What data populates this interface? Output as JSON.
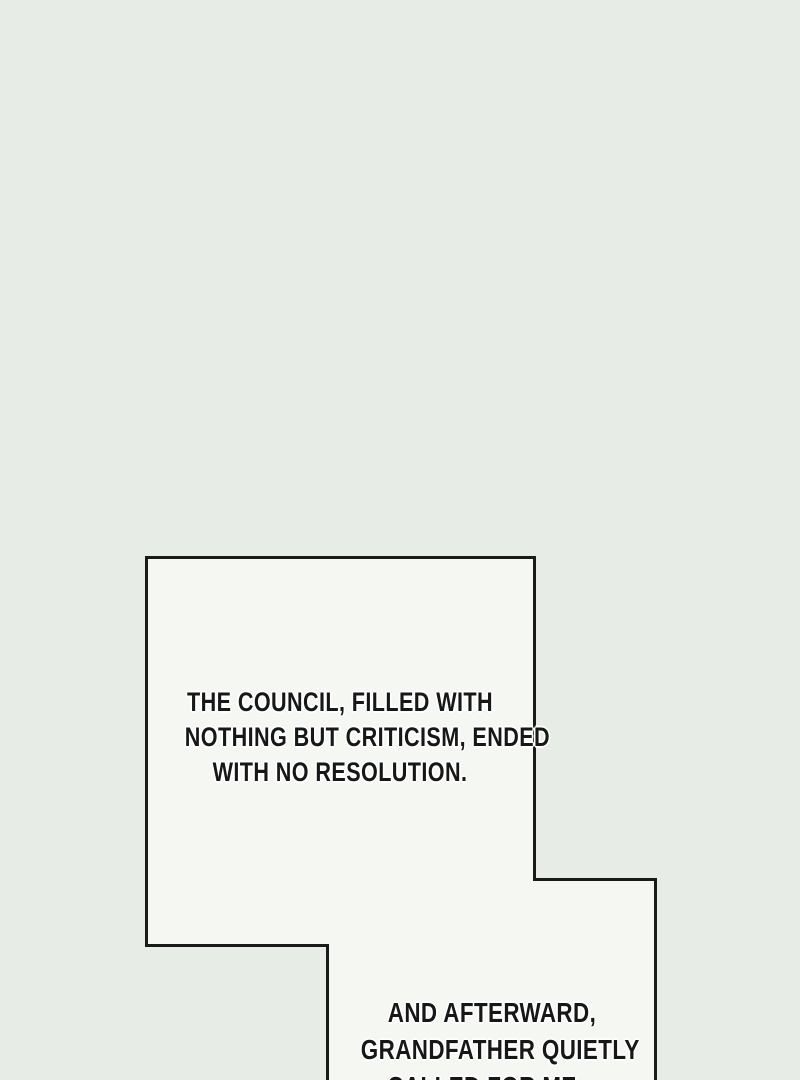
{
  "colors": {
    "background": "#e8ece7",
    "panel_fill": "#f5f7f3",
    "ink": "#1a1a1a",
    "text_color": "#171717",
    "halo": "#ffffff"
  },
  "captions": {
    "top": {
      "lines": [
        "THE COUNCIL, FILLED WITH",
        "NOTHING BUT CRITICISM, ENDED",
        "WITH NO RESOLUTION."
      ]
    },
    "bottom": {
      "lines": [
        "AND AFTERWARD,",
        "GRANDFATHER QUIETLY",
        "CALLED FOR ME..."
      ]
    }
  }
}
